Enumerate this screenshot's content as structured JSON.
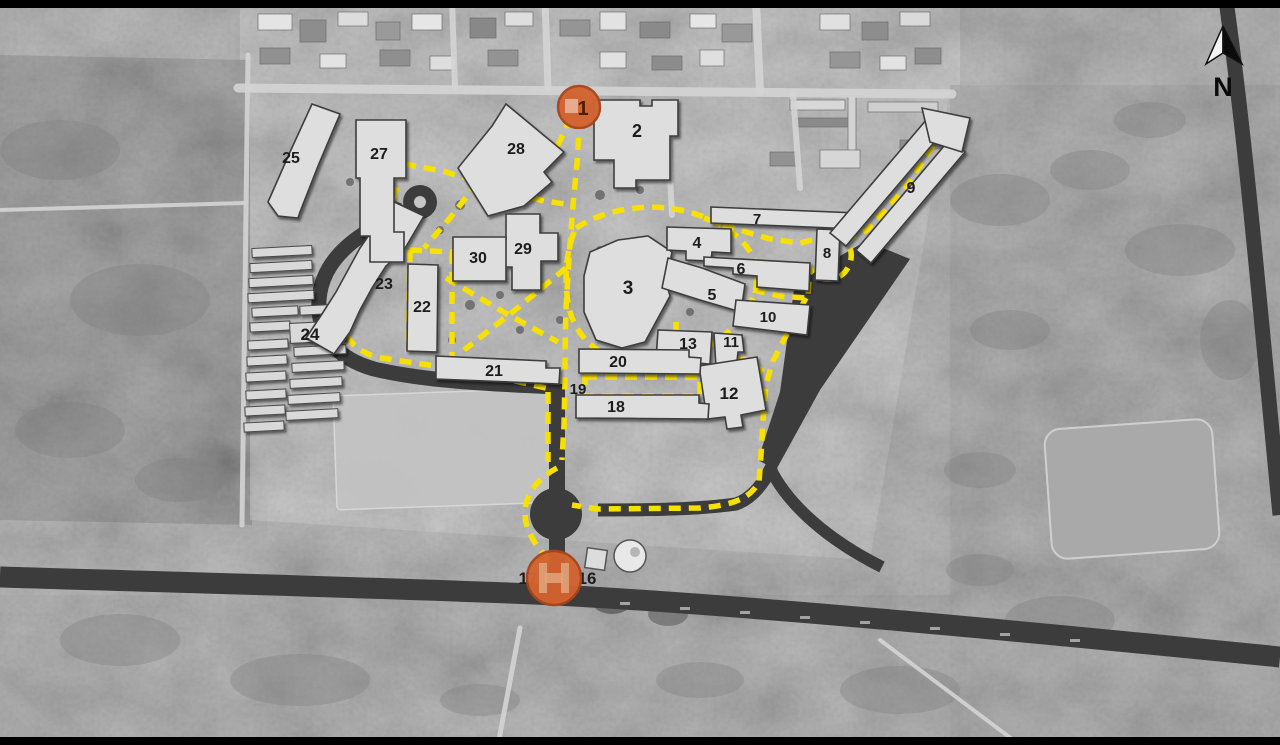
{
  "north": {
    "label": "N"
  },
  "colors": {
    "route_yellow": "#f7e103",
    "road_dark": "#3c3c3c",
    "road_light": "#d4d4d4",
    "building_fill": "#dedede",
    "building_stroke": "#3d3d3d",
    "marker_orange": "#d2632f",
    "marker_orange_dark": "#a8451c",
    "label_color": "#1c1c1c"
  },
  "map": {
    "markers": [
      {
        "name": "entrance-marker-1",
        "x": 579,
        "y": 107,
        "r": 21,
        "label": "1"
      },
      {
        "name": "entrance-marker-gate",
        "x": 554,
        "y": 578,
        "r": 27,
        "label": ""
      }
    ],
    "buildings": [
      {
        "num": "2",
        "lx": 637,
        "ly": 137,
        "fs": 18,
        "pts": [
          [
            594,
            100
          ],
          [
            640,
            100
          ],
          [
            640,
            106
          ],
          [
            652,
            106
          ],
          [
            652,
            100
          ],
          [
            678,
            100
          ],
          [
            678,
            136
          ],
          [
            670,
            136
          ],
          [
            670,
            180
          ],
          [
            636,
            180
          ],
          [
            636,
            188
          ],
          [
            614,
            188
          ],
          [
            614,
            160
          ],
          [
            594,
            160
          ]
        ]
      },
      {
        "num": "3",
        "lx": 628,
        "ly": 294,
        "fs": 19,
        "pts": [
          [
            590,
            252
          ],
          [
            618,
            240
          ],
          [
            648,
            236
          ],
          [
            672,
            252
          ],
          [
            666,
            282
          ],
          [
            670,
            296
          ],
          [
            645,
            342
          ],
          [
            622,
            348
          ],
          [
            596,
            340
          ],
          [
            584,
            312
          ],
          [
            584,
            276
          ]
        ]
      },
      {
        "num": "4",
        "lx": 697,
        "ly": 248,
        "fs": 16,
        "pts": [
          [
            667,
            227
          ],
          [
            731,
            229
          ],
          [
            731,
            253
          ],
          [
            712,
            252
          ],
          [
            711,
            261
          ],
          [
            686,
            260
          ],
          [
            686,
            251
          ],
          [
            667,
            250
          ]
        ]
      },
      {
        "num": "5",
        "lx": 712,
        "ly": 300,
        "fs": 16,
        "pts": [
          [
            668,
            258
          ],
          [
            702,
            268
          ],
          [
            745,
            284
          ],
          [
            741,
            312
          ],
          [
            700,
            300
          ],
          [
            662,
            288
          ]
        ]
      },
      {
        "num": "6",
        "lx": 741,
        "ly": 274,
        "fs": 16,
        "pts": [
          [
            704,
            257
          ],
          [
            810,
            263
          ],
          [
            809,
            291
          ],
          [
            757,
            287
          ],
          [
            757,
            276
          ],
          [
            733,
            274
          ],
          [
            733,
            268
          ],
          [
            704,
            266
          ]
        ]
      },
      {
        "num": "7",
        "lx": 757,
        "ly": 224,
        "fs": 15,
        "pts": [
          [
            711,
            207
          ],
          [
            857,
            213
          ],
          [
            856,
            229
          ],
          [
            711,
            223
          ]
        ]
      },
      {
        "num": "8",
        "lx": 827,
        "ly": 258,
        "fs": 15,
        "pts": [
          [
            817,
            229
          ],
          [
            840,
            230
          ],
          [
            838,
            281
          ],
          [
            815,
            280
          ]
        ]
      },
      {
        "num": "9",
        "lx": 911,
        "ly": 193,
        "fs": 16,
        "pts": [
          [
            830,
            233
          ],
          [
            927,
            119
          ],
          [
            943,
            132
          ],
          [
            846,
            246
          ]
        ]
      },
      {
        "num": "",
        "lx": 0,
        "ly": 0,
        "fs": 14,
        "pts": [
          [
            856,
            250
          ],
          [
            950,
            139
          ],
          [
            965,
            152
          ],
          [
            871,
            263
          ]
        ]
      },
      {
        "num": "",
        "lx": 0,
        "ly": 0,
        "fs": 14,
        "pts": [
          [
            922,
            108
          ],
          [
            970,
            118
          ],
          [
            962,
            152
          ],
          [
            930,
            142
          ]
        ]
      },
      {
        "num": "10",
        "lx": 768,
        "ly": 322,
        "fs": 15,
        "pts": [
          [
            736,
            300
          ],
          [
            810,
            305
          ],
          [
            807,
            335
          ],
          [
            733,
            326
          ]
        ]
      },
      {
        "num": "11",
        "lx": 731,
        "ly": 347,
        "fs": 15,
        "pts": [
          [
            714,
            333
          ],
          [
            742,
            335
          ],
          [
            744,
            352
          ],
          [
            738,
            352
          ],
          [
            736,
            370
          ],
          [
            716,
            368
          ]
        ]
      },
      {
        "num": "12",
        "lx": 729,
        "ly": 399,
        "fs": 17,
        "pts": [
          [
            699,
            366
          ],
          [
            757,
            357
          ],
          [
            766,
            410
          ],
          [
            741,
            415
          ],
          [
            743,
            427
          ],
          [
            727,
            429
          ],
          [
            725,
            417
          ],
          [
            707,
            419
          ]
        ]
      },
      {
        "num": "13",
        "lx": 688,
        "ly": 349,
        "fs": 16,
        "pts": [
          [
            658,
            330
          ],
          [
            712,
            332
          ],
          [
            710,
            364
          ],
          [
            656,
            360
          ]
        ]
      },
      {
        "num": "18",
        "lx": 616,
        "ly": 412,
        "fs": 16,
        "pts": [
          [
            576,
            395
          ],
          [
            699,
            395
          ],
          [
            699,
            403
          ],
          [
            709,
            404
          ],
          [
            708,
            419
          ],
          [
            576,
            418
          ]
        ]
      },
      {
        "num": "20",
        "lx": 618,
        "ly": 367,
        "fs": 16,
        "pts": [
          [
            579,
            349
          ],
          [
            689,
            350
          ],
          [
            689,
            357
          ],
          [
            701,
            358
          ],
          [
            700,
            374
          ],
          [
            579,
            373
          ]
        ]
      },
      {
        "num": "21",
        "lx": 494,
        "ly": 376,
        "fs": 16,
        "pts": [
          [
            436,
            356
          ],
          [
            546,
            361
          ],
          [
            546,
            368
          ],
          [
            560,
            368
          ],
          [
            559,
            384
          ],
          [
            436,
            379
          ]
        ]
      },
      {
        "num": "22",
        "lx": 422,
        "ly": 312,
        "fs": 16,
        "pts": [
          [
            408,
            264
          ],
          [
            438,
            265
          ],
          [
            437,
            352
          ],
          [
            407,
            351
          ]
        ]
      },
      {
        "num": "23",
        "lx": 384,
        "ly": 289,
        "fs": 16,
        "pts": [
          [
            390,
            200
          ],
          [
            424,
            216
          ],
          [
            404,
            250
          ],
          [
            386,
            266
          ],
          [
            372,
            288
          ],
          [
            360,
            310
          ],
          [
            350,
            332
          ],
          [
            334,
            354
          ],
          [
            306,
            338
          ],
          [
            322,
            314
          ],
          [
            336,
            292
          ],
          [
            348,
            270
          ],
          [
            360,
            248
          ],
          [
            374,
            228
          ]
        ]
      },
      {
        "num": "25",
        "lx": 291,
        "ly": 163,
        "fs": 16,
        "pts": [
          [
            268,
            202
          ],
          [
            290,
            152
          ],
          [
            312,
            104
          ],
          [
            340,
            114
          ],
          [
            318,
            166
          ],
          [
            300,
            212
          ],
          [
            298,
            218
          ],
          [
            278,
            216
          ]
        ]
      },
      {
        "num": "27",
        "lx": 379,
        "ly": 159,
        "fs": 16,
        "pts": [
          [
            356,
            120
          ],
          [
            406,
            120
          ],
          [
            406,
            178
          ],
          [
            394,
            178
          ],
          [
            394,
            232
          ],
          [
            404,
            232
          ],
          [
            404,
            262
          ],
          [
            370,
            262
          ],
          [
            370,
            236
          ],
          [
            360,
            236
          ],
          [
            360,
            178
          ],
          [
            356,
            178
          ]
        ]
      },
      {
        "num": "28",
        "lx": 516,
        "ly": 154,
        "fs": 16,
        "pts": [
          [
            506,
            104
          ],
          [
            564,
            152
          ],
          [
            544,
            172
          ],
          [
            552,
            182
          ],
          [
            524,
            206
          ],
          [
            488,
            216
          ],
          [
            458,
            168
          ],
          [
            492,
            126
          ]
        ]
      },
      {
        "num": "29",
        "lx": 523,
        "ly": 254,
        "fs": 16,
        "pts": [
          [
            506,
            214
          ],
          [
            540,
            214
          ],
          [
            540,
            233
          ],
          [
            558,
            233
          ],
          [
            558,
            261
          ],
          [
            541,
            261
          ],
          [
            541,
            290
          ],
          [
            512,
            290
          ],
          [
            512,
            267
          ],
          [
            489,
            267
          ],
          [
            489,
            239
          ],
          [
            506,
            239
          ]
        ]
      },
      {
        "num": "30",
        "lx": 478,
        "ly": 263,
        "fs": 16,
        "pts": [
          [
            453,
            237
          ],
          [
            506,
            237
          ],
          [
            506,
            281
          ],
          [
            453,
            281
          ]
        ]
      }
    ],
    "barracks": [
      [
        252,
        247,
        60,
        9
      ],
      [
        250,
        262,
        62,
        9
      ],
      [
        249,
        277,
        64,
        9
      ],
      [
        248,
        292,
        66,
        9
      ],
      [
        252,
        307,
        46,
        9
      ],
      [
        300,
        305,
        46,
        9
      ],
      [
        250,
        322,
        40,
        9
      ],
      [
        290,
        322,
        56,
        20
      ],
      [
        248,
        340,
        40,
        9
      ],
      [
        294,
        346,
        52,
        9
      ],
      [
        247,
        356,
        40,
        9
      ],
      [
        292,
        362,
        52,
        9
      ],
      [
        246,
        372,
        40,
        9
      ],
      [
        290,
        378,
        52,
        9
      ],
      [
        246,
        390,
        40,
        9
      ],
      [
        288,
        394,
        52,
        9
      ],
      [
        245,
        406,
        40,
        9
      ],
      [
        286,
        410,
        52,
        9
      ],
      [
        244,
        422,
        40,
        9
      ]
    ],
    "labels": [
      {
        "text": "19",
        "x": 578,
        "y": 394,
        "fs": 15
      },
      {
        "text": "17",
        "x": 528,
        "y": 584,
        "fs": 17
      },
      {
        "text": "16",
        "x": 587,
        "y": 584,
        "fs": 17
      },
      {
        "text": "24",
        "x": 310,
        "y": 340,
        "fs": 17
      }
    ],
    "routes": [
      {
        "name": "route-spine",
        "d": "M580,118 L577,163 L573,205 L569,258 L566,308 L565,352 L565,376 L564,425 L562,460"
      },
      {
        "name": "route-left-vertical",
        "d": "M548,392 L548,462"
      },
      {
        "name": "route-roundabout-arc",
        "d": "M557,468 C538,478 525,494 525,513 C525,532 537,548 554,566"
      },
      {
        "name": "route-gate1-sw",
        "d": "M571,117 L549,164 L513,192"
      },
      {
        "name": "route-28-to-spine",
        "d": "M513,192 L544,201 L573,205"
      },
      {
        "name": "route-27-to-28",
        "d": "M404,164 L443,171 L478,182 L513,192"
      },
      {
        "name": "route-28-to-22",
        "d": "M478,182 L450,218 L424,248"
      },
      {
        "name": "route-22-left",
        "d": "M410,250 L408,352"
      },
      {
        "name": "route-22-right",
        "d": "M452,252 L452,356"
      },
      {
        "name": "route-22-top",
        "d": "M410,250 L452,252"
      },
      {
        "name": "route-23-side",
        "d": "M402,168 L392,204 L380,236 L364,268 L350,300 L344,330 C348,342 360,352 376,357 L408,362 L436,366"
      },
      {
        "name": "route-21-bottom",
        "d": "M436,366 L475,373 L515,381 L546,388"
      },
      {
        "name": "route-quad-diag-1",
        "d": "M446,278 L500,310 L558,342"
      },
      {
        "name": "route-quad-diag-2",
        "d": "M566,268 L515,310 L464,350"
      },
      {
        "name": "route-loop-building3",
        "d": "M576,228 C600,212 640,202 680,210 C715,217 745,235 755,262 C762,285 752,310 727,333 C700,357 660,366 630,362 C600,358 580,340 571,315 C563,290 565,250 576,228 Z"
      },
      {
        "name": "route-to-7-8",
        "d": "M704,218 L736,229 L770,239 L800,243 L837,234"
      },
      {
        "name": "route-loop-8",
        "d": "M837,234 C852,242 856,258 845,272 C835,283 816,281 810,268 L808,296"
      },
      {
        "name": "route-along-9",
        "d": "M845,241 L867,230 L906,187 L948,123"
      },
      {
        "name": "route-junction-10",
        "d": "M753,290 L780,296 L806,298"
      },
      {
        "name": "route-to-12-road",
        "d": "M806,298 L789,330 L773,361 L766,384 L763,420 L761,455 L759,482 C750,498 735,505 700,508 L598,509 L572,505"
      },
      {
        "name": "route-13-down",
        "d": "M676,322 L676,358"
      },
      {
        "name": "route-above-12",
        "d": "M676,358 L712,357 L748,360 L763,372"
      },
      {
        "name": "route-yard-19",
        "d": "M585,377 L700,377 L700,396 L585,396 Z"
      }
    ],
    "roads_dark": [
      {
        "name": "road-highway",
        "d": "M0,577 C200,583 400,588 556,595 C760,606 1040,633 1280,657",
        "w": 21
      },
      {
        "name": "road-gate-vertical",
        "d": "M557,597 L557,384",
        "w": 16
      },
      {
        "name": "road-campus-west",
        "d": "M557,387 C490,384 424,381 374,369 C332,357 317,331 319,300 C321,272 338,251 362,235 C380,223 391,211 395,201",
        "w": 15
      },
      {
        "name": "road-topright-diag",
        "d": "M1226,0 C1247,150 1261,320 1280,515",
        "w": 15
      },
      {
        "name": "road-branch-highway",
        "d": "M770,468 C788,505 828,540 882,567",
        "w": 12
      },
      {
        "name": "road-west-connector",
        "d": "M772,466 C762,487 750,499 736,504 C700,509 660,510 598,510",
        "w": 13
      }
    ],
    "road_shapes": [
      {
        "name": "parking-wedge",
        "type": "path",
        "d": "M795,282 L866,241 L910,259 L820,390 L776,470 L758,460 L780,392 Z"
      },
      {
        "name": "roundabout",
        "type": "circle",
        "cx": 556,
        "cy": 514,
        "r": 26
      },
      {
        "name": "loop-turnaround",
        "type": "circle",
        "cx": 420,
        "cy": 202,
        "r": 17
      },
      {
        "name": "loop-island",
        "type": "circle",
        "cx": 420,
        "cy": 202,
        "r": 6,
        "fill": "#c6c6c6"
      }
    ],
    "roads_light": [
      {
        "d": "M238,88 L952,94",
        "w": 9
      },
      {
        "d": "M756,0 L760,92",
        "w": 8
      },
      {
        "d": "M452,0 L455,88",
        "w": 6
      },
      {
        "d": "M545,0 L548,88",
        "w": 7
      },
      {
        "d": "M793,94 L800,188",
        "w": 6
      },
      {
        "d": "M668,138 L672,215",
        "w": 6
      },
      {
        "d": "M248,55 L242,525",
        "w": 5
      },
      {
        "d": "M0,210 L244,203",
        "w": 4
      },
      {
        "d": "M520,628 L498,745",
        "w": 5
      },
      {
        "d": "M880,640 L1020,745",
        "w": 4
      }
    ]
  }
}
